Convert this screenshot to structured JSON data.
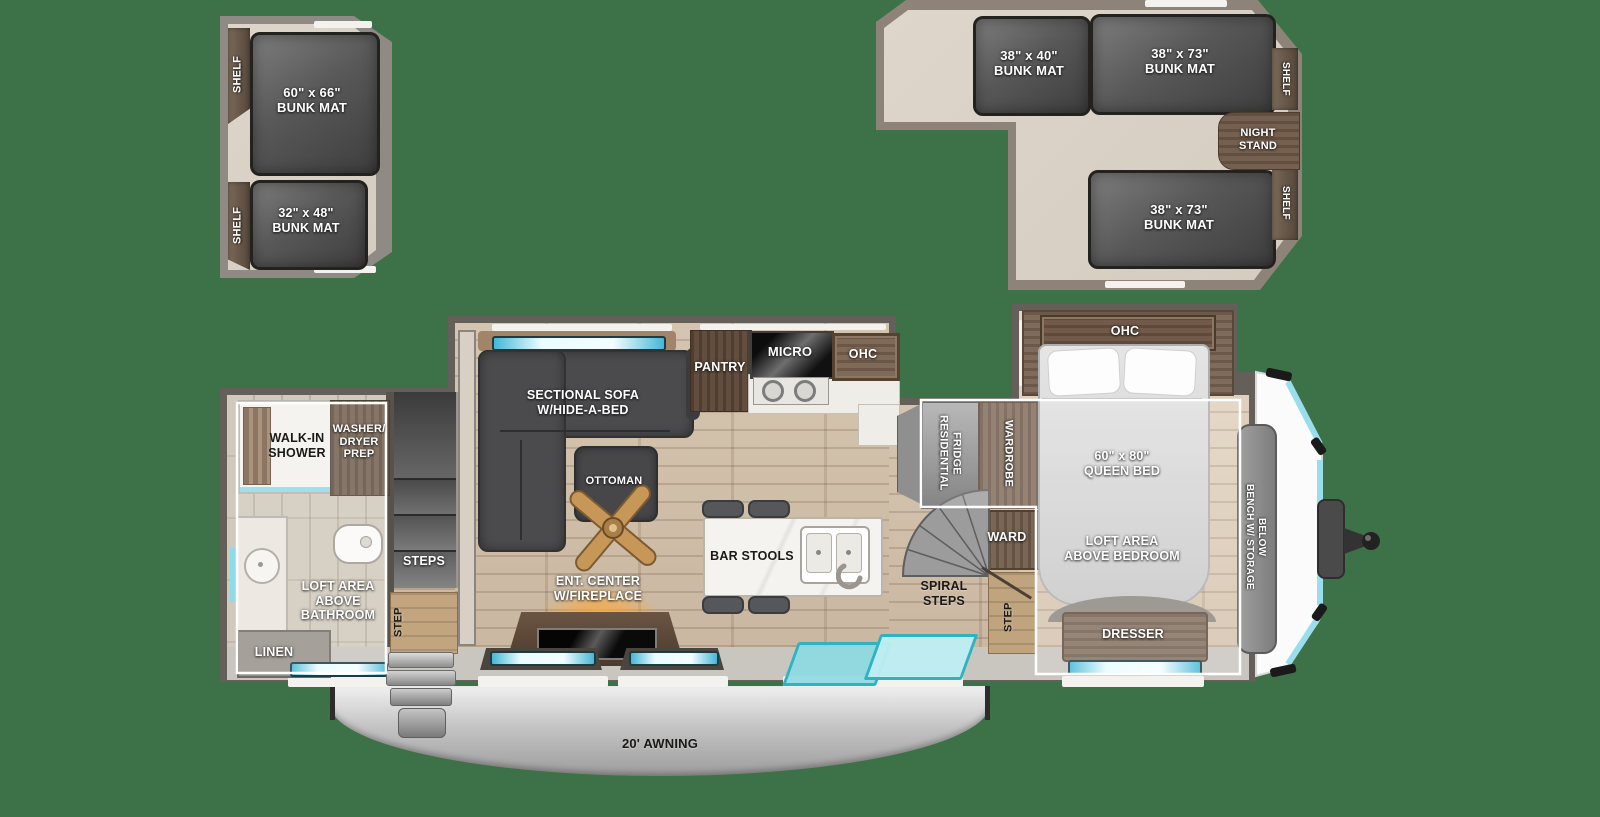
{
  "colors": {
    "background": "#3d7147",
    "window_cyan": "#a9e6ef",
    "door_teal": "#8fdce2",
    "glow_orange": "#ffa733",
    "overlay_white": "#ffffff"
  },
  "rear_loft": {
    "shelf_top": "SHELF",
    "shelf_bottom": "SHELF",
    "bunk_large": "60\" x 66\"\nBUNK MAT",
    "bunk_small": "32\" x 48\"\nBUNK MAT"
  },
  "front_loft": {
    "bunk_left": "38\" x 40\"\nBUNK MAT",
    "bunk_right": "38\" x 73\"\nBUNK MAT",
    "bunk_lower": "38\" x 73\"\nBUNK MAT",
    "night_stand": "NIGHT\nSTAND",
    "shelf_top": "SHELF",
    "shelf_bottom": "SHELF"
  },
  "bathroom": {
    "shower": "WALK-IN\nSHOWER",
    "washer_dryer": "WASHER/\nDRYER\nPREP",
    "loft_note": "LOFT AREA\nABOVE\nBATHROOM",
    "linen": "LINEN"
  },
  "stairs": {
    "steps": "STEPS",
    "entry_step": "STEP"
  },
  "living": {
    "sofa": "SECTIONAL SOFA\nW/HIDE-A-BED",
    "ottoman": "OTTOMAN",
    "ent_center": "ENT. CENTER\nW/FIREPLACE"
  },
  "kitchen": {
    "pantry": "PANTRY",
    "micro": "MICRO",
    "ohc": "OHC",
    "bar_stools": "BAR STOOLS"
  },
  "mid": {
    "fridge": "RESIDENTIAL\nFRIDGE",
    "wardrobe": "WARDROBE",
    "ward": "WARD",
    "spiral_steps": "SPIRAL\nSTEPS",
    "step": "STEP"
  },
  "bedroom": {
    "ohc": "OHC",
    "queen_bed": "60\" x 80\"\nQUEEN BED",
    "loft_note": "LOFT AREA\nABOVE BEDROOM",
    "dresser": "DRESSER",
    "bench": "BENCH W/ STORAGE\nBELOW"
  },
  "exterior": {
    "awning": "20' AWNING"
  }
}
